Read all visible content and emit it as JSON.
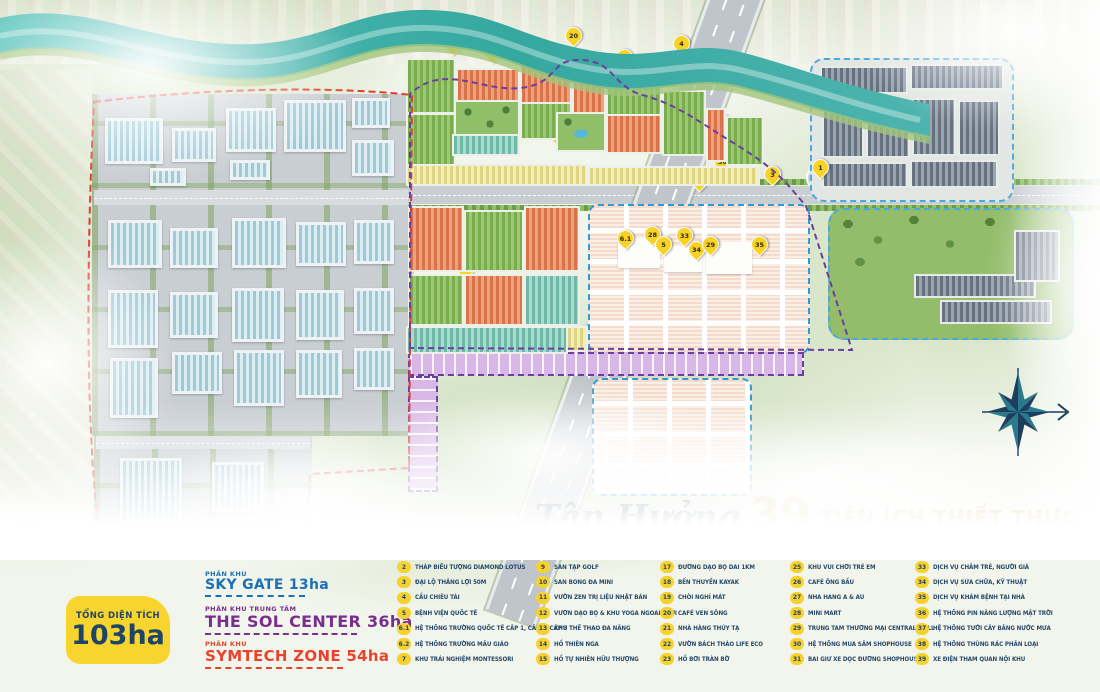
{
  "title": {
    "script": "Tận Hưởng",
    "number": "39",
    "suffix": "TIỆN ÍCH THIẾT THỰC"
  },
  "area_badge": {
    "label": "TỔNG DIỆN TÍCH",
    "value": "103ha"
  },
  "zones": [
    {
      "label": "PHÂN KHU",
      "name": "SKY GATE 13ha",
      "color": "#1a6fb5"
    },
    {
      "label": "PHÂN KHU TRUNG TÂM",
      "name": "THE SOL CENTER 36ha",
      "color": "#7a2f8f"
    },
    {
      "label": "PHÂN KHU",
      "name": "SYMTECH ZONE 54ha",
      "color": "#e8432e"
    }
  ],
  "colors": {
    "accent_gold": "#c7963b",
    "navy_text": "#27496b",
    "badge_yellow": "#f7d22e",
    "river_teal": "#3fb3aa",
    "symtech_border_red": "#e23c2e",
    "sol_border_purple": "#6b3fa0",
    "skygate_border_blue": "#4aa8e0"
  },
  "amenities": [
    {
      "no": "1",
      "label": "VÒNG XOAY ĐẠI THẾ GIỚI"
    },
    {
      "no": "2",
      "label": "THÁP BIỂU TƯỢNG DIAMOND LOTUS"
    },
    {
      "no": "3",
      "label": "ĐẠI LỘ THẮNG LỢI 50M"
    },
    {
      "no": "4",
      "label": "CẦU CHIÊU TÀI"
    },
    {
      "no": "5",
      "label": "BỆNH VIỆN QUỐC TẾ"
    },
    {
      "no": "6.1",
      "label": "HỆ THỐNG TRƯỜNG QUỐC TẾ CẤP 1, CẤP 2, CẤP 3"
    },
    {
      "no": "6.2",
      "label": "HỆ THỐNG TRƯỜNG MẪU GIÁO"
    },
    {
      "no": "7",
      "label": "KHU TRẢI NGHIỆM MONTESSORI"
    },
    {
      "no": "8",
      "label": "QUẢNG TRƯỜNG NGHỆ THUẬT POP ART"
    },
    {
      "no": "9",
      "label": "SÂN TẬP GOLF"
    },
    {
      "no": "10",
      "label": "SÂN BÓNG ĐÁ MINI"
    },
    {
      "no": "11",
      "label": "VƯỜN ZEN TRỊ LIỆU NHẬT BẢN"
    },
    {
      "no": "12",
      "label": "VƯỜN DẠO BỘ & KHU YOGA NGOÀI TRỜI"
    },
    {
      "no": "13",
      "label": "KHU THỂ THAO ĐA NĂNG"
    },
    {
      "no": "14",
      "label": "HỒ THIÊN NGA"
    },
    {
      "no": "15",
      "label": "HỒ TỰ NHIÊN HỮU THƯỢNG"
    },
    {
      "no": "16",
      "label": "CÔNG VIÊN VEN SÔNG PAVO RIVERSIDE"
    },
    {
      "no": "17",
      "label": "ĐƯỜNG DẠO BỘ DÀI 1KM"
    },
    {
      "no": "18",
      "label": "BẾN THUYỀN KAYAK"
    },
    {
      "no": "19",
      "label": "CHÒI NGHỈ MÁT"
    },
    {
      "no": "20",
      "label": "CAFÉ VEN SÔNG"
    },
    {
      "no": "21",
      "label": "NHÀ HÀNG THỦY TẠ"
    },
    {
      "no": "22",
      "label": "VƯỜN BÁCH THẢO LIFE ECO"
    },
    {
      "no": "23",
      "label": "HỒ BƠI TRÀN BỜ"
    },
    {
      "no": "24",
      "label": "XÔNG HƠI THẢO DƯỢC & SPA GYM"
    },
    {
      "no": "25",
      "label": "KHU VUI CHƠI TRẺ EM"
    },
    {
      "no": "26",
      "label": "CAFÉ ÔNG BẦU"
    },
    {
      "no": "27",
      "label": "NHÀ HÀNG Á & ÂU"
    },
    {
      "no": "28",
      "label": "MINI MART"
    },
    {
      "no": "29",
      "label": "TRUNG TÂM THƯƠNG MẠI CENTRAL MALL"
    },
    {
      "no": "30",
      "label": "HỆ THỐNG MUA SẮM SHOPHOUSE"
    },
    {
      "no": "31",
      "label": "BÃI GIỮ XE DỌC ĐƯỜNG SHOPHOUSE"
    },
    {
      "no": "32",
      "label": "CAMERA AN NINH & BẢO VỆ"
    },
    {
      "no": "33",
      "label": "DỊCH VỤ CHĂM TRẺ, NGƯỜI GIÀ"
    },
    {
      "no": "34",
      "label": "DỊCH VỤ SỬA CHỮA, KỸ THUẬT"
    },
    {
      "no": "35",
      "label": "DỊCH VỤ KHÁM BỆNH TẠI NHÀ"
    },
    {
      "no": "36",
      "label": "HỆ THỐNG PIN NĂNG LƯỢNG MẶT TRỜI"
    },
    {
      "no": "37",
      "label": "HỆ THỐNG TƯỚI CÂY BẰNG NƯỚC MƯA"
    },
    {
      "no": "38",
      "label": "HỆ THỐNG THÙNG RÁC PHÂN LOẠI"
    },
    {
      "no": "39",
      "label": "XE ĐIỆN THAM QUAN NỘI KHU"
    }
  ],
  "map": {
    "markers": [
      {
        "no": "12",
        "x": 425,
        "y": 36
      },
      {
        "no": "19",
        "x": 452,
        "y": 53
      },
      {
        "no": "18",
        "x": 492,
        "y": 61
      },
      {
        "no": "15",
        "x": 537,
        "y": 57
      },
      {
        "no": "20",
        "x": 573,
        "y": 44
      },
      {
        "no": "21",
        "x": 624,
        "y": 66
      },
      {
        "no": "17",
        "x": 643,
        "y": 75
      },
      {
        "no": "4",
        "x": 681,
        "y": 52
      },
      {
        "no": "16",
        "x": 684,
        "y": 78
      },
      {
        "no": "6",
        "x": 457,
        "y": 107
      },
      {
        "no": "10",
        "x": 466,
        "y": 122
      },
      {
        "no": "27",
        "x": 493,
        "y": 117
      },
      {
        "no": "14",
        "x": 502,
        "y": 113
      },
      {
        "no": "22",
        "x": 512,
        "y": 117
      },
      {
        "no": "13",
        "x": 560,
        "y": 123
      },
      {
        "no": "9",
        "x": 571,
        "y": 122
      },
      {
        "no": "8",
        "x": 578,
        "y": 129
      },
      {
        "no": "23",
        "x": 596,
        "y": 127
      },
      {
        "no": "25",
        "x": 588,
        "y": 134
      },
      {
        "no": "24",
        "x": 596,
        "y": 141
      },
      {
        "no": "26",
        "x": 575,
        "y": 145
      },
      {
        "no": "31",
        "x": 558,
        "y": 144
      },
      {
        "no": "11",
        "x": 723,
        "y": 132
      },
      {
        "no": "30",
        "x": 722,
        "y": 170
      },
      {
        "no": "2",
        "x": 699,
        "y": 189
      },
      {
        "no": "3",
        "x": 772,
        "y": 183
      },
      {
        "no": "1",
        "x": 820,
        "y": 176
      },
      {
        "no": "6.1",
        "x": 625,
        "y": 247
      },
      {
        "no": "28",
        "x": 652,
        "y": 243
      },
      {
        "no": "5",
        "x": 663,
        "y": 253
      },
      {
        "no": "33",
        "x": 684,
        "y": 244
      },
      {
        "no": "34",
        "x": 696,
        "y": 258
      },
      {
        "no": "29",
        "x": 710,
        "y": 253
      },
      {
        "no": "35",
        "x": 759,
        "y": 253
      },
      {
        "no": "7",
        "x": 420,
        "y": 265
      },
      {
        "no": "6.2",
        "x": 465,
        "y": 277
      }
    ]
  }
}
